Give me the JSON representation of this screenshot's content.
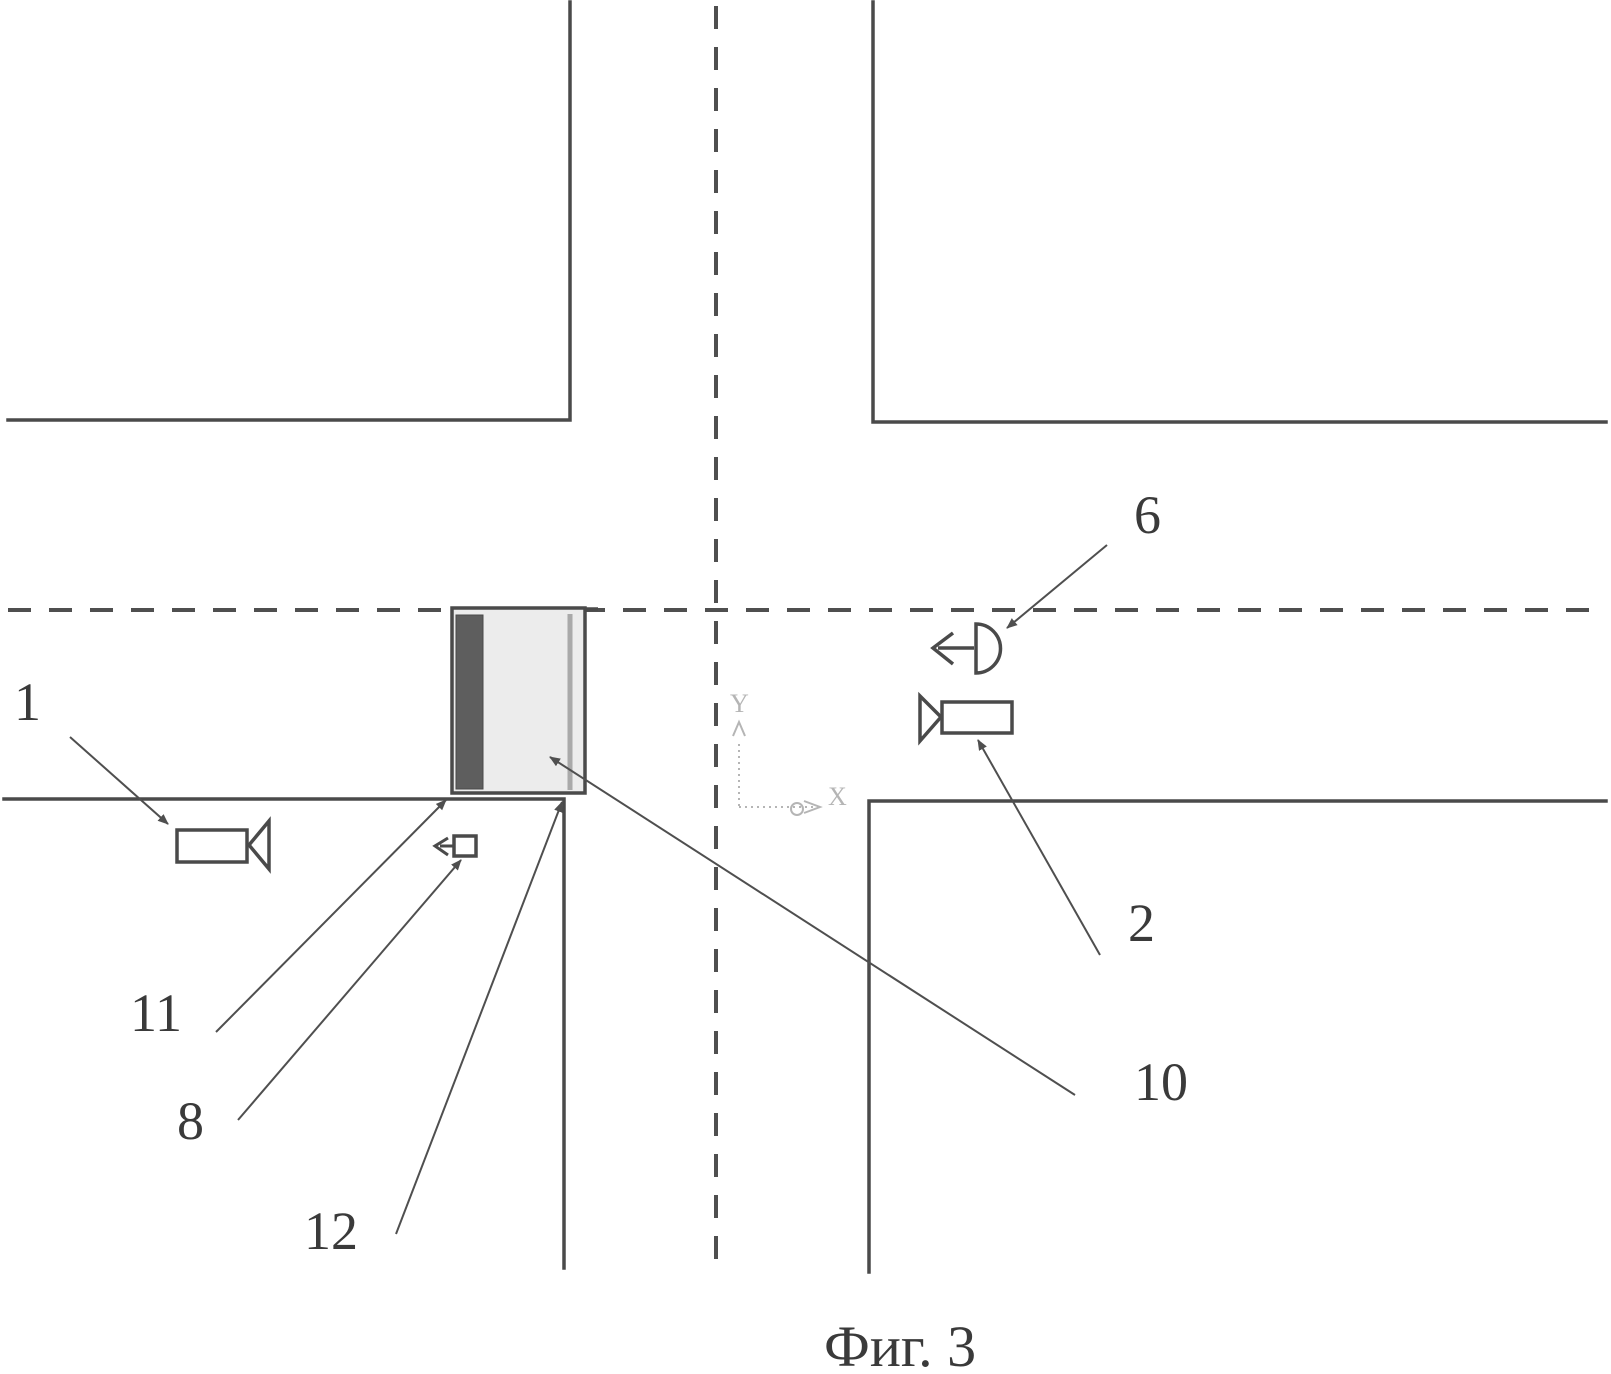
{
  "figure_caption": "Фиг. 3",
  "labels": {
    "l1": "1",
    "l2": "2",
    "l6": "6",
    "l8": "8",
    "l10": "10",
    "l11": "11",
    "l12": "12"
  },
  "axes": {
    "x_label": "X",
    "y_label": "Y"
  },
  "icons": {
    "camera_left": "video-camera-icon",
    "camera_right": "video-camera-icon",
    "detector_upper": "direction-detector-icon",
    "detector_lower": "direction-detector-icon",
    "coordinate_axes": "coordinate-axes-icon"
  },
  "colors": {
    "background": "#ffffff",
    "road_line": "#4a4a4a",
    "dashed_center_line": "#4f4f4f",
    "zone_fill": "#ececec",
    "zone_dark_bar": "#5e5e5e",
    "zone_stripe": "#a9a9a9",
    "pointer_line": "#4f4f4f",
    "label_text": "#3a3a3a",
    "axes_icon": "#b5b5b5"
  }
}
